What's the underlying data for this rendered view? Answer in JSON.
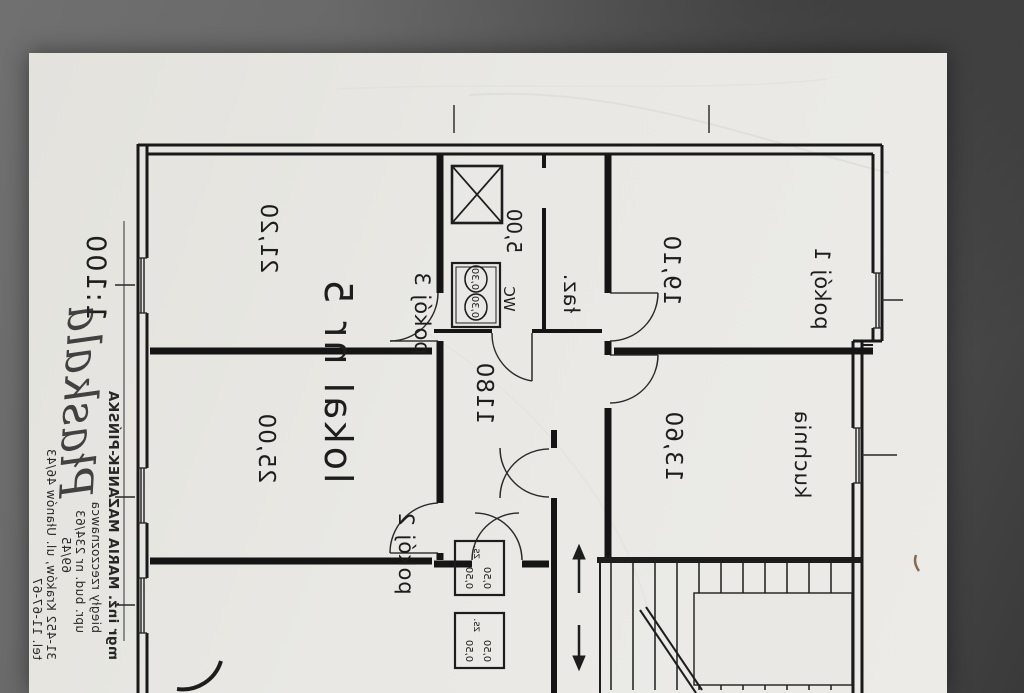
{
  "colors": {
    "paper": "#e9e8e4",
    "ink": "#1a1a1a",
    "background_surface": "#585858"
  },
  "document": {
    "scale_label": "1:100",
    "signature": "Płaskala",
    "stamp": {
      "name": "mgr inż. MARIA MAZANEK-PIŃSKA",
      "title": "biegły rzeczoznawca",
      "license": "upr. bud. nr 234/63",
      "license2": "69/45",
      "address": "31-452 Kraków, ul. Ułanów 46/43",
      "phone": "tel. 11-67-67"
    },
    "plan": {
      "unit_label": "lokal nr 5",
      "rooms": {
        "pokoj1": {
          "label": "pokój 1",
          "area": "19,10"
        },
        "pokoj2": {
          "label": "pokój 2",
          "area": "25,00"
        },
        "pokoj3": {
          "label": "pokój 3",
          "area": "21,20"
        },
        "kuchnia": {
          "label": "kuchnia",
          "area": "13,60"
        },
        "lazienka": {
          "label": "łaz.",
          "area": "5,00"
        },
        "wc": {
          "label": "WC",
          "fixture_dims": [
            "0,30",
            "0,30"
          ]
        },
        "hall": {
          "area": "1180"
        }
      },
      "stair_boxes": {
        "label": "zs.",
        "dims": [
          "0,50",
          "0,50"
        ]
      }
    }
  }
}
